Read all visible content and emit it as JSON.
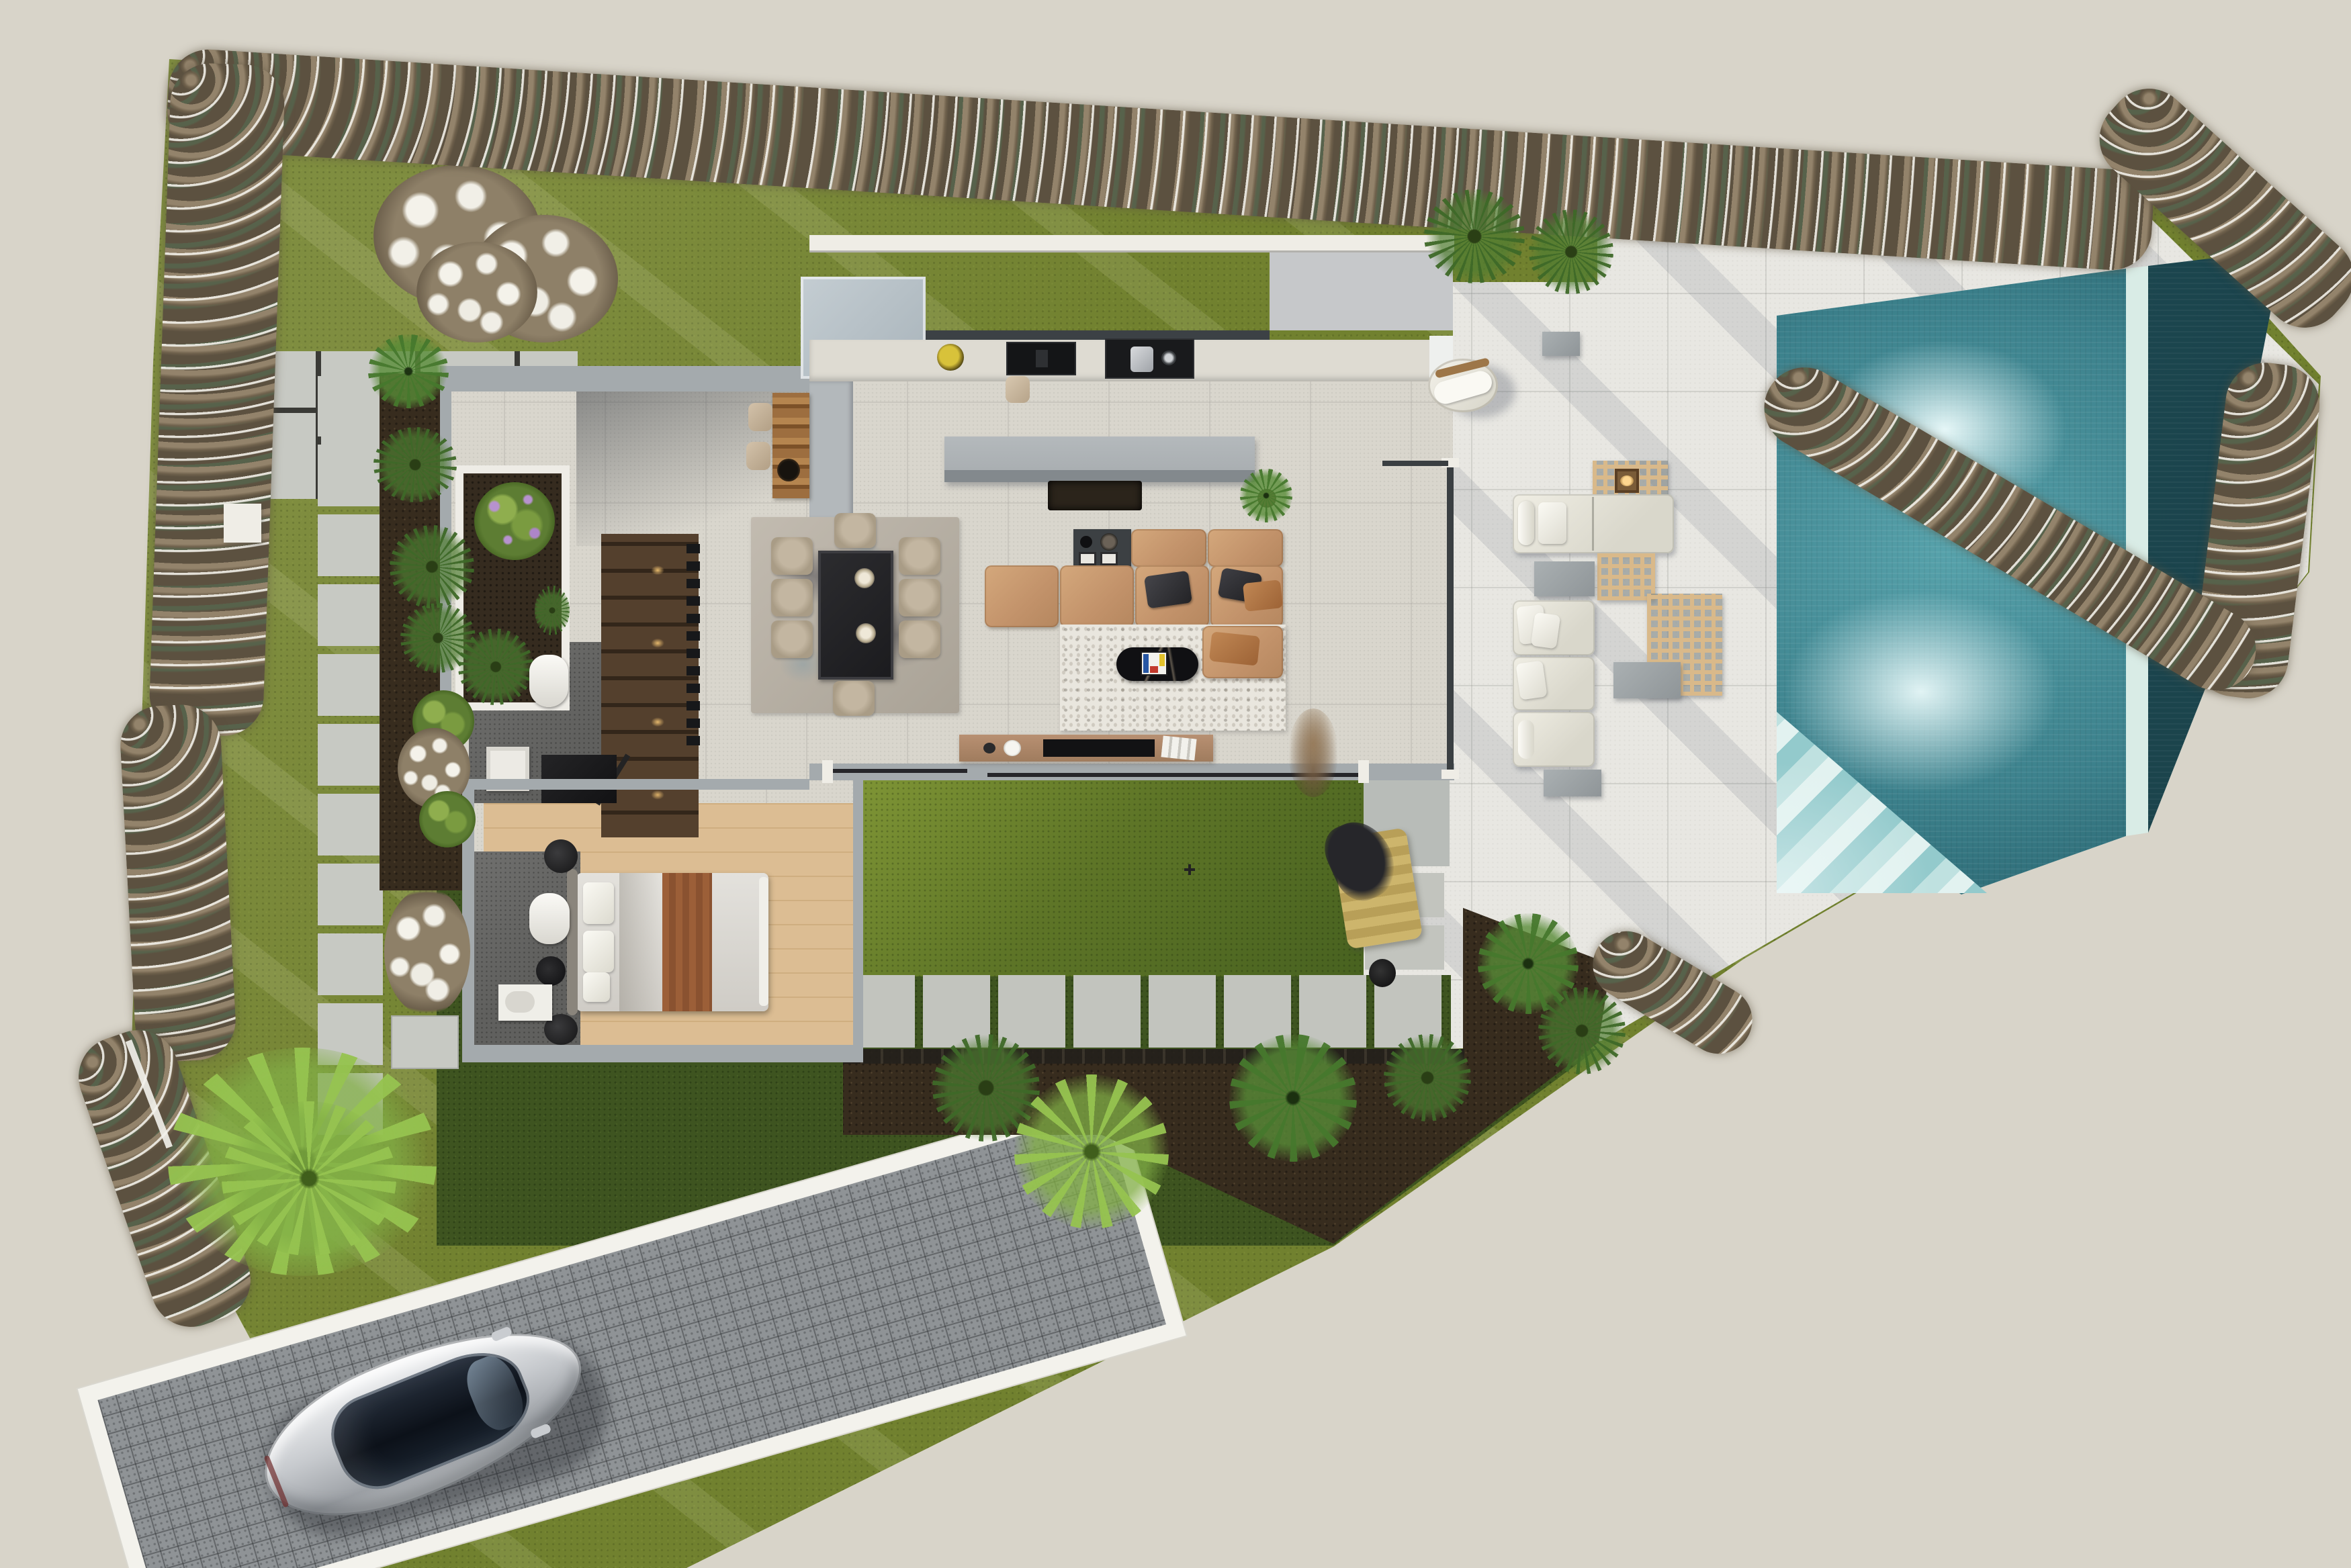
{
  "scene": {
    "title": "Modern villa site plan — photorealistic top-down render",
    "view": "top-down aerial",
    "background_color": "#d8d4c9"
  },
  "zones": {
    "front_lawn": {
      "label": "Front lawn with white-flowering tree"
    },
    "hedge_border": {
      "label": "White flowering hedge along property walls"
    },
    "garden_path": {
      "label": "Stepping-stone garden path"
    },
    "entry_apron": {
      "label": "Entry paving apron"
    },
    "pool_terrace": {
      "label": "Pool terrace with outdoor lounge"
    },
    "swimming_pool": {
      "label": "Swimming pool with lap lane and corner steps"
    },
    "inner_court": {
      "label": "Inner courtyard lawn"
    },
    "back_beds": {
      "label": "Planting beds with palms"
    },
    "driveway": {
      "label": "Cobbled driveway with parked car"
    }
  },
  "house": {
    "label": "Single-storey villa floor plan",
    "rooms": [
      {
        "name": "entry-hall",
        "features": [
          "interior planter",
          "timber feature stair with spotlights",
          "open pivot door"
        ]
      },
      {
        "name": "stairwell",
        "features": [
          "18 concrete treads",
          "skylight void"
        ]
      },
      {
        "name": "kitchen",
        "features": [
          "wall counter",
          "black induction cooktop",
          "black sink unit",
          "fruit bowl",
          "island",
          "timber bar with 2 cube stools"
        ]
      },
      {
        "name": "dining-area",
        "features": [
          "glass table with black frame",
          "8 upholstered chairs",
          "2 disc pendant lights",
          "abstract beige rug"
        ]
      },
      {
        "name": "living-area",
        "features": [
          "tan leather modular sectional",
          "charcoal cushions",
          "rust cushions",
          "black oval marble coffee table",
          "colorful art book",
          "ivory shag rug",
          "charcoal side table with decor",
          "walnut media console with TV",
          "potted monstera",
          "dried pampas arrangement"
        ]
      },
      {
        "name": "guest-wc",
        "features": [
          "toilet",
          "basin",
          "dark wardrobe"
        ]
      },
      {
        "name": "bedroom",
        "features": [
          "oak floor",
          "double bed with grey bedding",
          "rust throw",
          "2 round nightstands"
        ]
      },
      {
        "name": "ensuite",
        "features": [
          "toilet",
          "vanity",
          "black stool"
        ]
      }
    ]
  },
  "pool": {
    "water_color": "#3f8a95",
    "lap_lane_color": "#24535d",
    "divider": "light walkway strip",
    "corner_steps": 5,
    "underwater_lights": 2
  },
  "terrace_furniture": {
    "round_lounge_chairs": 1,
    "modular_lounge_seats": 4,
    "chaise_modules": 2,
    "lattice_tables": 3,
    "gray_side_tables": 4,
    "lantern": 1,
    "floor_cushion": "mustard with black throw"
  },
  "vehicle": {
    "type": "sedan",
    "color": "silver",
    "roof": "black panoramic glass",
    "location": "driveway"
  },
  "vegetation": {
    "flowering_tree": 1,
    "hedge": "white flowering shrub border",
    "palms": 9,
    "cycads": 7,
    "shrubs": "green and lavender accents"
  },
  "counts": {
    "path_slabs": 11,
    "garden_slab_row": 8,
    "apron_slabs": 8,
    "court_slab_pairs": 2,
    "dining_chairs": 8
  },
  "palette": {
    "background": "#d8d4c9",
    "lawn": "#71812f",
    "dark_lawn": "#3e5420",
    "patio": "#e8e7e2",
    "pool": "#3f8a95",
    "cobble": "#8f9396",
    "wall_gray": "#a4aaad",
    "wall_white": "#efede6",
    "sofa_tan": "#c2926a",
    "wood": "#d3b186"
  }
}
